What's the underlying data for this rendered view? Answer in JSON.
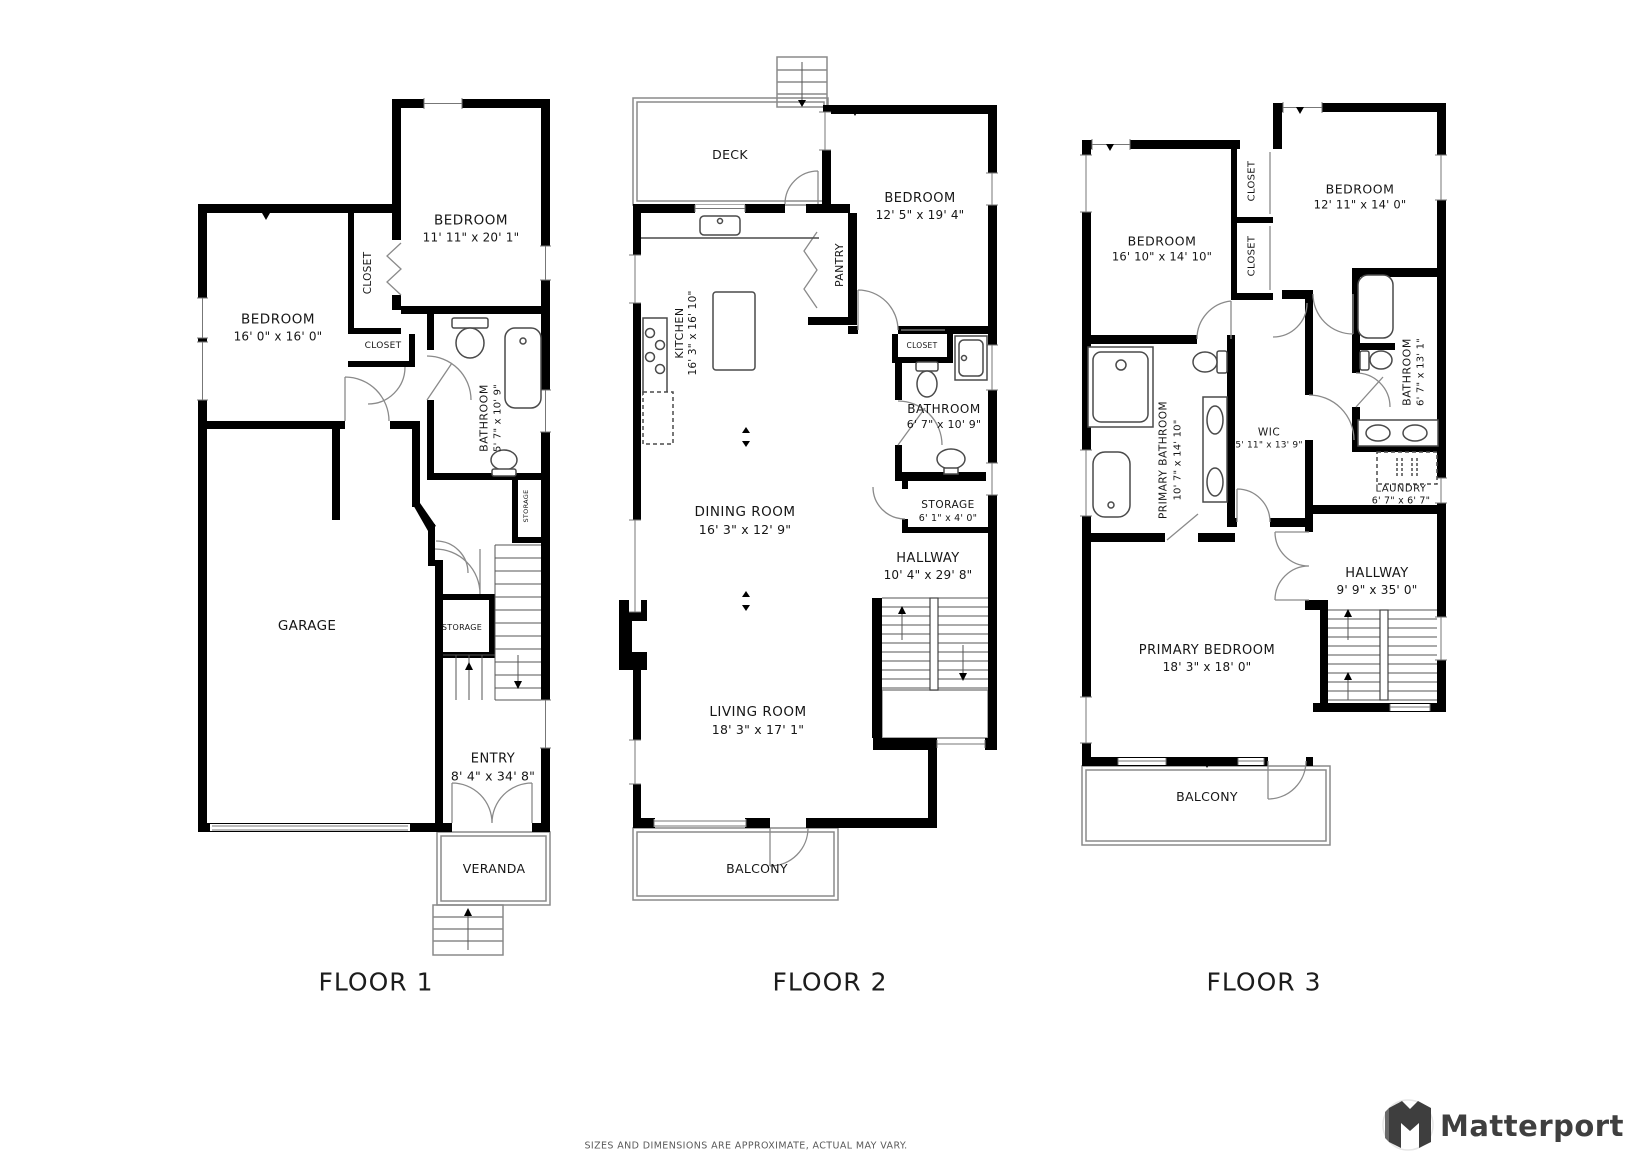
{
  "floors": [
    {
      "label": "FLOOR 1",
      "rooms": [
        {
          "name": "BEDROOM",
          "dims": "11' 11\" x 20' 1\""
        },
        {
          "name": "BEDROOM",
          "dims": "16' 0\" x 16' 0\""
        },
        {
          "name": "CLOSET"
        },
        {
          "name": "CLOSET"
        },
        {
          "name": "BATHROOM",
          "dims": "5' 7\" x 10' 9\""
        },
        {
          "name": "STORAGE"
        },
        {
          "name": "GARAGE"
        },
        {
          "name": "STORAGE"
        },
        {
          "name": "ENTRY",
          "dims": "8' 4\" x 34' 8\""
        },
        {
          "name": "VERANDA"
        }
      ]
    },
    {
      "label": "FLOOR 2",
      "rooms": [
        {
          "name": "DECK"
        },
        {
          "name": "KITCHEN",
          "dims": "16' 3\" x 16' 10\""
        },
        {
          "name": "PANTRY"
        },
        {
          "name": "BEDROOM",
          "dims": "12' 5\" x 19' 4\""
        },
        {
          "name": "CLOSET"
        },
        {
          "name": "BATHROOM",
          "dims": "6' 7\" x 10' 9\""
        },
        {
          "name": "STORAGE",
          "dims": "6' 1\" x 4' 0\""
        },
        {
          "name": "HALLWAY",
          "dims": "10' 4\" x 29' 8\""
        },
        {
          "name": "DINING ROOM",
          "dims": "16' 3\" x 12' 9\""
        },
        {
          "name": "LIVING ROOM",
          "dims": "18' 3\" x 17' 1\""
        },
        {
          "name": "BALCONY"
        }
      ]
    },
    {
      "label": "FLOOR 3",
      "rooms": [
        {
          "name": "BEDROOM",
          "dims": "16' 10\" x 14' 10\""
        },
        {
          "name": "CLOSET"
        },
        {
          "name": "CLOSET"
        },
        {
          "name": "BEDROOM",
          "dims": "12' 11\" x 14' 0\""
        },
        {
          "name": "PRIMARY BATHROOM",
          "dims": "10' 7\" x 14' 10\""
        },
        {
          "name": "WIC",
          "dims": "5' 11\" x 13' 9\""
        },
        {
          "name": "BATHROOM",
          "dims": "6' 7\" x 13' 1\""
        },
        {
          "name": "LAUNDRY",
          "dims": "6' 7\" x 6' 7\""
        },
        {
          "name": "HALLWAY",
          "dims": "9' 9\" x 35' 0\""
        },
        {
          "name": "PRIMARY BEDROOM",
          "dims": "18' 3\" x 18' 0\""
        },
        {
          "name": "BALCONY"
        }
      ]
    }
  ],
  "footer": {
    "disclaimer": "SIZES AND DIMENSIONS ARE APPROXIMATE, ACTUAL MAY VARY.",
    "brand": "Matterport",
    "brand_icon": "matterport-m-cube-icon"
  },
  "colors": {
    "walls": "#000000",
    "thin_outline": "#8a8a8a",
    "text": "#161616",
    "brand_text": "#3f3f3f"
  }
}
